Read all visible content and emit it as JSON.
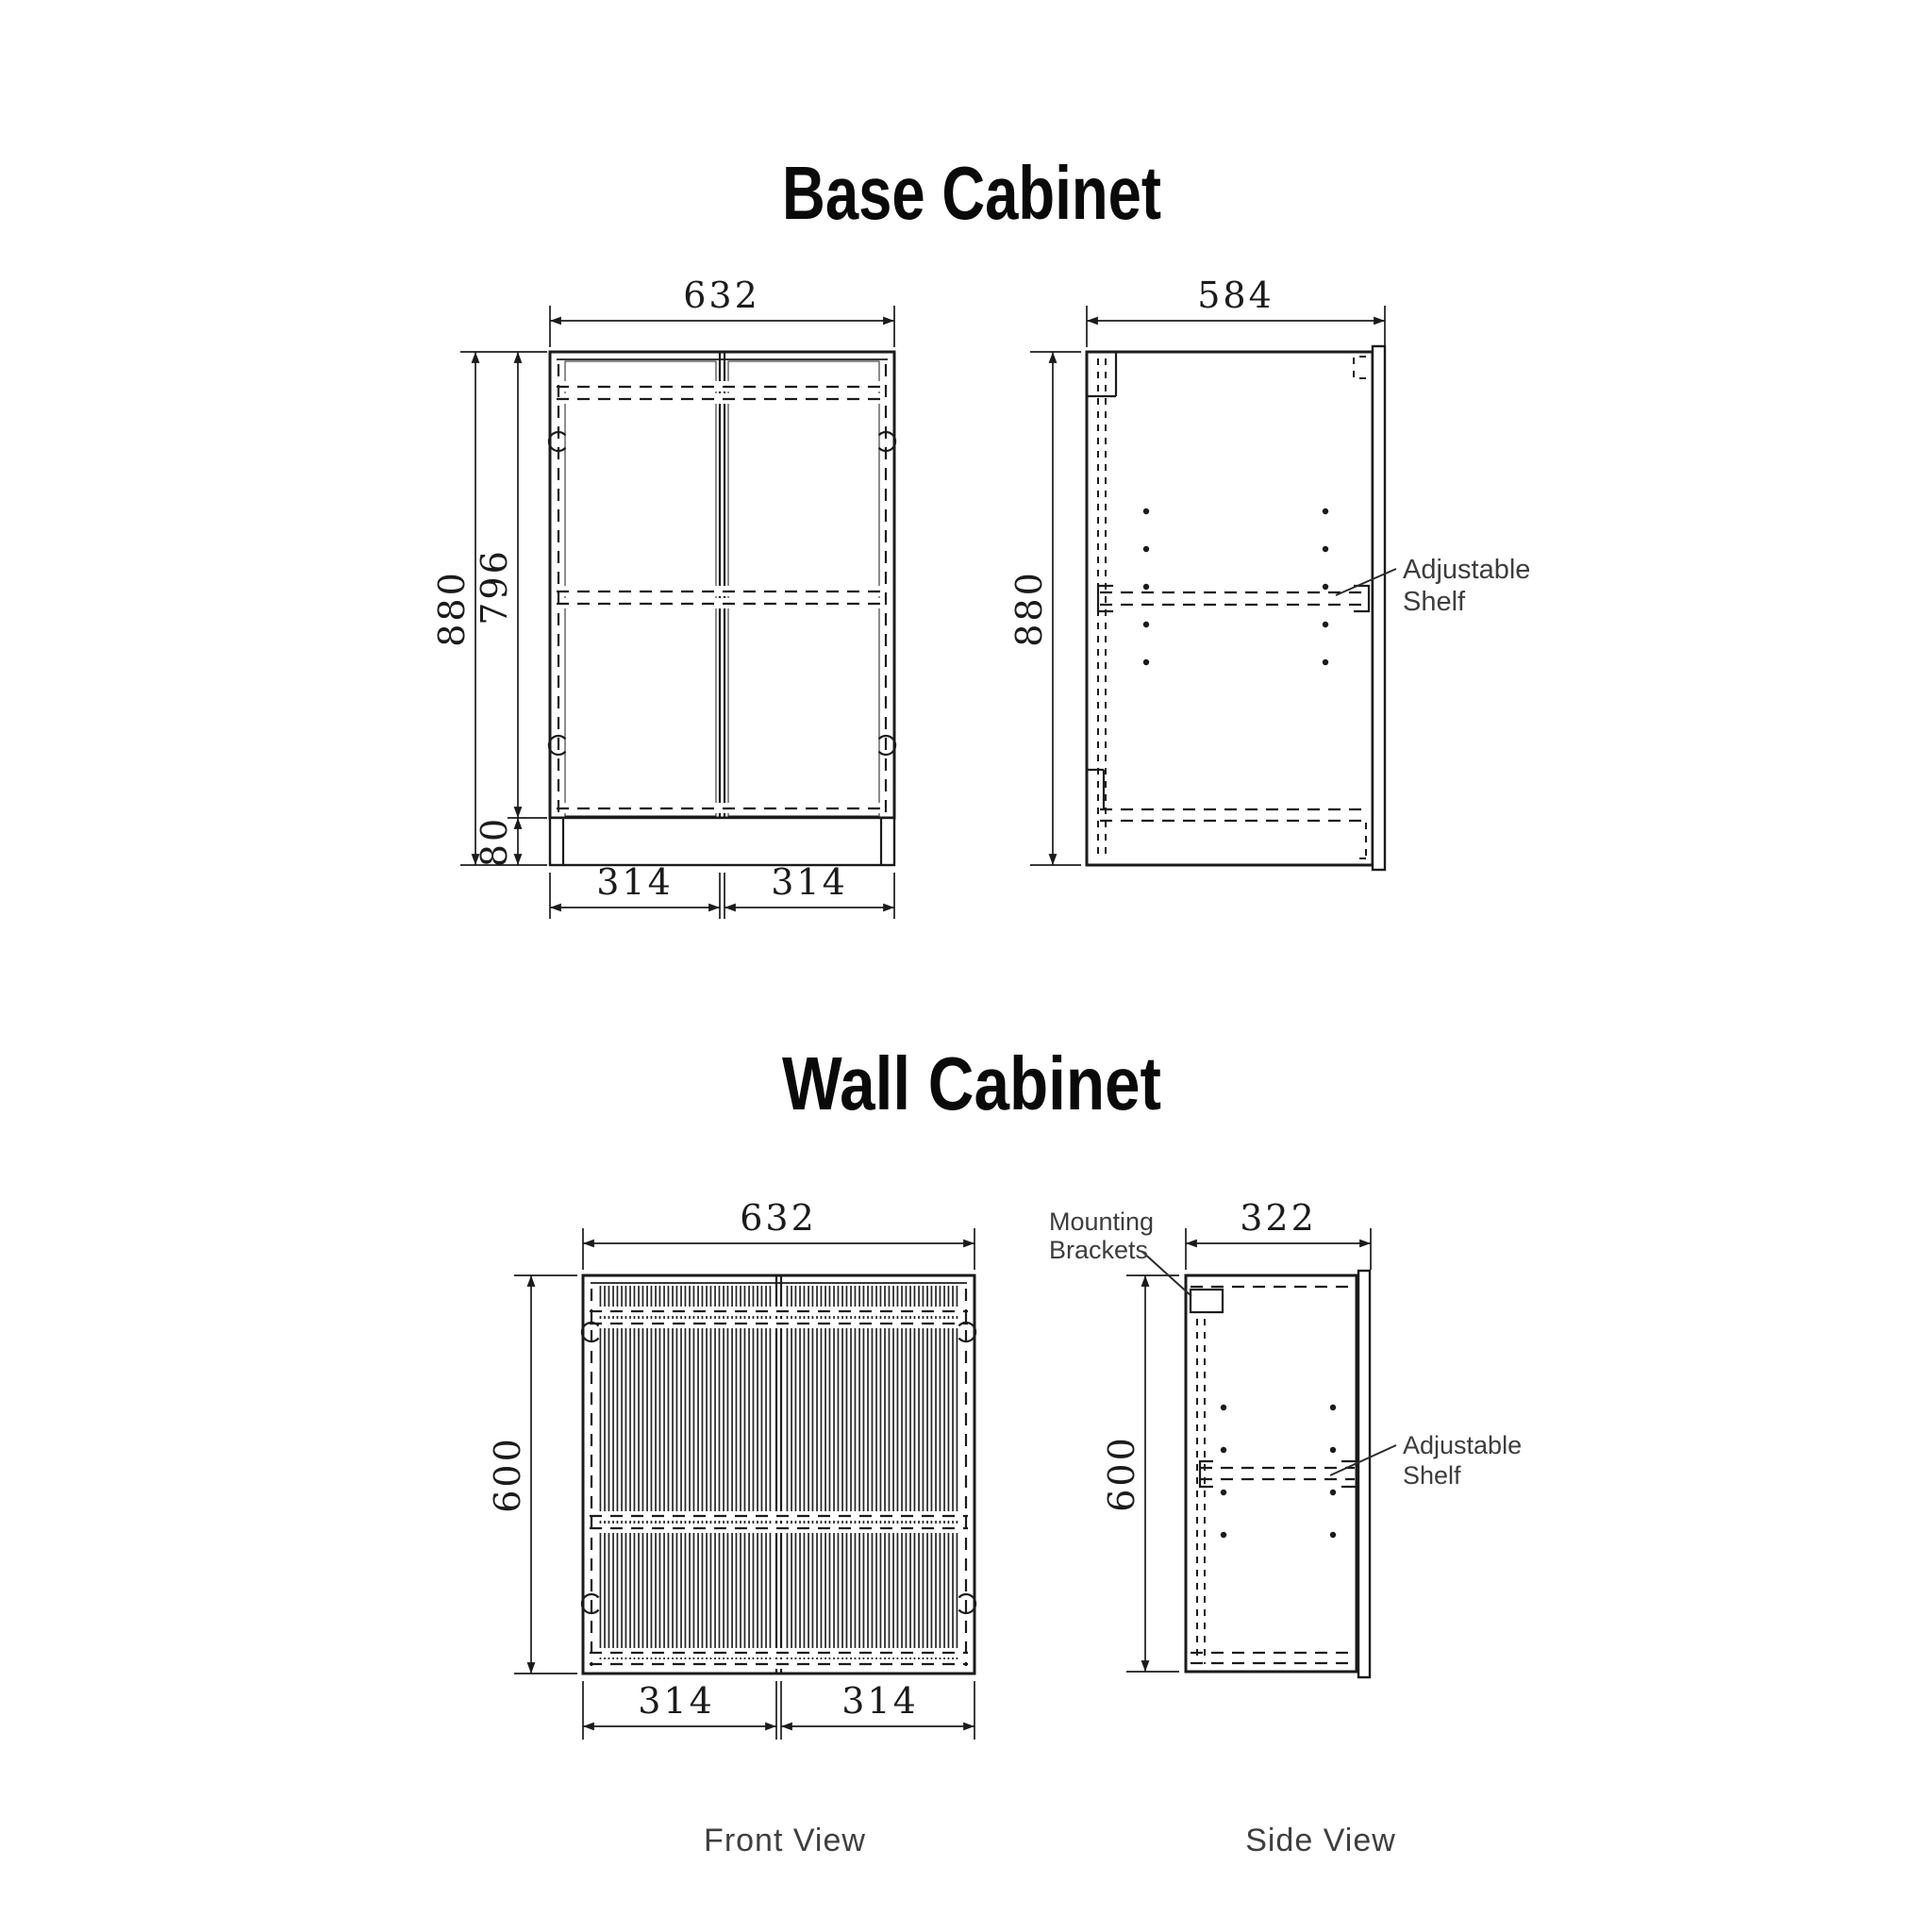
{
  "colors": {
    "ink": "#1b1b1b",
    "label": "#3d3d3d",
    "title": "#0a0a0a",
    "background": "#ffffff"
  },
  "base_cabinet": {
    "title": "Base Cabinet",
    "front": {
      "width": "632",
      "height": "880",
      "door_height": "796",
      "plinth_height": "80",
      "left_door_width": "314",
      "right_door_width": "314"
    },
    "side": {
      "depth": "584",
      "height": "880",
      "shelf_label_line1": "Adjustable",
      "shelf_label_line2": "Shelf"
    }
  },
  "wall_cabinet": {
    "title": "Wall Cabinet",
    "front": {
      "width": "632",
      "height": "600",
      "left_door_width": "314",
      "right_door_width": "314"
    },
    "side": {
      "depth": "322",
      "height": "600",
      "brackets_label_line1": "Mounting",
      "brackets_label_line2": "Brackets",
      "shelf_label_line1": "Adjustable",
      "shelf_label_line2": "Shelf"
    }
  },
  "footer": {
    "front_view_label": "Front View",
    "side_view_label": "Side View"
  }
}
